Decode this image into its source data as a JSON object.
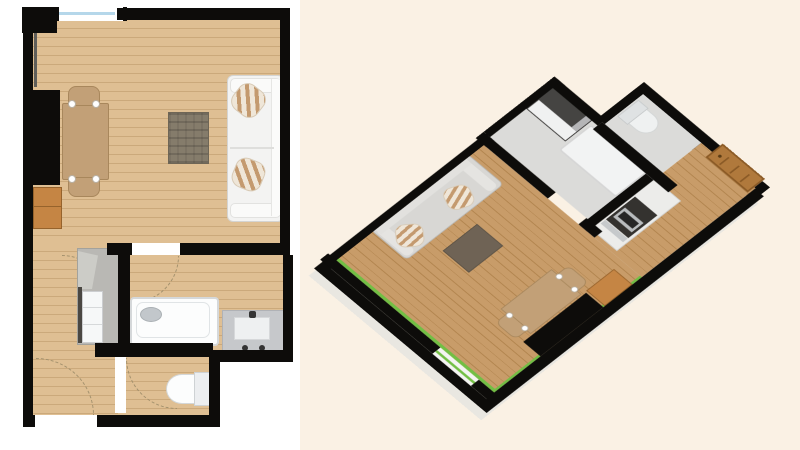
{
  "scene": {
    "left_view": {
      "name": "2d-floor-plan-top-view",
      "rooms": [
        "living-room",
        "hallway",
        "bathroom",
        "sink-room",
        "wc"
      ],
      "furniture": [
        "dining-table",
        "dining-chair",
        "dining-chair",
        "area-rug",
        "sofa",
        "throw-pillow",
        "throw-pillow",
        "storage-cabinet",
        "kitchen-unit",
        "refrigerator",
        "bathtub",
        "sink-vanity",
        "toilet"
      ],
      "openings": [
        "window",
        "living-room-door-opening",
        "wc-door-opening",
        "entry-door-opening"
      ],
      "annotations": [
        "door-swing-arcs-dashed"
      ]
    },
    "right_view": {
      "name": "3d-floor-plan-perspective-view",
      "rotation": "rotated-oblique-aerial",
      "furniture": [
        "sofa",
        "throw-pillow",
        "area-rug",
        "dining-table",
        "dining-chair",
        "dining-chair",
        "storage-cabinet",
        "kitchen-stove-unit",
        "bathtub",
        "sink-vanity",
        "toilet",
        "entry-door"
      ]
    }
  },
  "colors": {
    "canvas_bg": "#ffffff",
    "iso_bg": "#faf1e4",
    "wall": "#0d0c0a",
    "wood": "#dfbf93",
    "wood_line": "#cba97b",
    "wood3d": "#c89c69",
    "wood3d_line": "#b2854f",
    "floor_gray": "#dbdbd9",
    "window_glass": "#b5d7ea",
    "baseboard_green": "#72bf44",
    "rug_2d": "#857c6b",
    "rug_3d": "#6f6355",
    "sofa_body": "#f3f3f2",
    "pillow_stripe": "#c49a6f",
    "table_wood": "#c2a077",
    "cabinet_wood": "#c58544",
    "kitchen_gray": "#b9b8b4",
    "fixture_white": "#fcfdfd",
    "vanity_gray": "#c6c8cb",
    "metal_dark": "#343434",
    "door_wood": "#b0793c"
  }
}
